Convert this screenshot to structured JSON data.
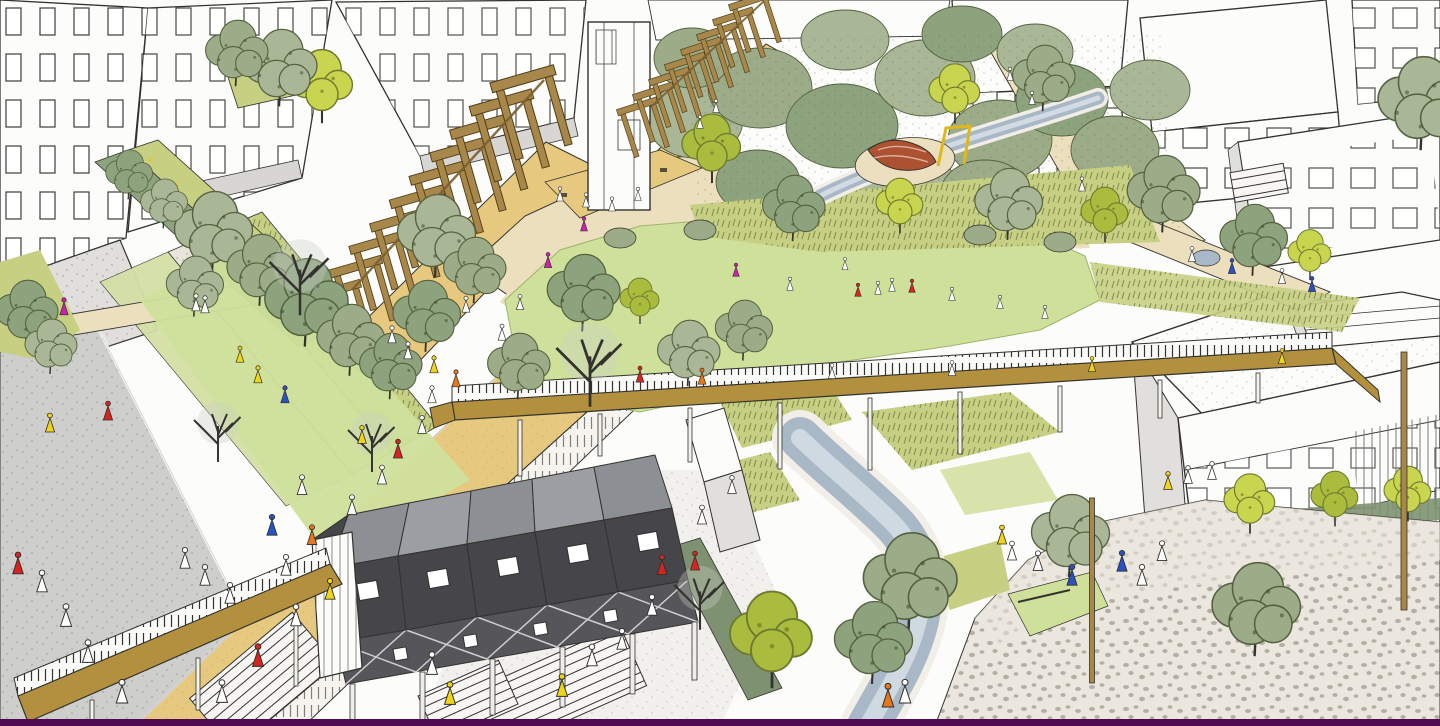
{
  "meta": {
    "scene_label": "Hand-drawn aerial masterplan sketch of an urban park with buildings, lawn, pergola, stream and plaza"
  },
  "palette": {
    "paper": "#fcfcfa",
    "ink": "#33322e",
    "buildingShade": "#e0dfdb",
    "roofGray": "#d7d6d2",
    "lawn": "#cfe09b",
    "grassWild": "#c6cf82",
    "treeSage": "#a9b796",
    "treeSageDark": "#8ca37e",
    "treeOlive": "#9cab88",
    "treeBright": "#c9d44f",
    "treeBrightDark": "#aabc3e",
    "pathBeige": "#ecdfbe",
    "sand": "#e6c87f",
    "deckOchre": "#b2903e",
    "wood": "#a8874a",
    "woodDark": "#6b5422",
    "water": "#a9b8c6",
    "waterLight": "#d6dee5",
    "roadGray": "#cecfcc",
    "plaza": "#ece7de",
    "darkWall": "#45454a",
    "darkRoof": "#8c8f93",
    "hedge": "#7e9271",
    "accentRed": "#d62420",
    "accentOrange": "#e5781c",
    "accentYellow": "#efd41c",
    "accentBlue": "#2a52c4",
    "accentMagenta": "#cf1fae",
    "purpleStrip": "#4d0a50",
    "playRed": "#ad5230",
    "playYellow": "#ddb818"
  },
  "people_colors": {
    "r": "accentRed",
    "o": "accentOrange",
    "y": "accentYellow",
    "b": "accentBlue",
    "m": "accentMagenta",
    "w": "#ffffff"
  },
  "scene": {
    "trees": [
      {
        "v": "sage",
        "x": 215,
        "y": 235,
        "s": 1.5
      },
      {
        "v": "sage",
        "x": 262,
        "y": 272,
        "s": 1.3
      },
      {
        "v": "sage",
        "x": 308,
        "y": 305,
        "s": 1.6
      },
      {
        "v": "sage",
        "x": 196,
        "y": 288,
        "s": 1.1
      },
      {
        "v": "sage",
        "x": 352,
        "y": 342,
        "s": 1.3
      },
      {
        "v": "sage",
        "x": 392,
        "y": 368,
        "s": 1.2
      },
      {
        "v": "bare",
        "x": 300,
        "y": 262,
        "s": 1.9
      },
      {
        "v": "bare",
        "x": 218,
        "y": 420,
        "s": 1.5
      },
      {
        "v": "sage",
        "x": 438,
        "y": 238,
        "s": 1.5
      },
      {
        "v": "sage",
        "x": 476,
        "y": 272,
        "s": 1.2
      },
      {
        "v": "sage",
        "x": 428,
        "y": 318,
        "s": 1.3
      },
      {
        "v": "bright",
        "x": 322,
        "y": 88,
        "s": 1.6
      },
      {
        "v": "sage",
        "x": 282,
        "y": 70,
        "s": 1.4
      },
      {
        "v": "sage",
        "x": 238,
        "y": 55,
        "s": 1.2
      },
      {
        "v": "bare",
        "x": 372,
        "y": 430,
        "s": 1.5
      },
      {
        "v": "sage",
        "x": 585,
        "y": 295,
        "s": 1.4
      },
      {
        "v": "bare",
        "x": 590,
        "y": 348,
        "s": 2.1
      },
      {
        "v": "sage",
        "x": 690,
        "y": 355,
        "s": 1.2
      },
      {
        "v": "sage",
        "x": 745,
        "y": 332,
        "s": 1.1
      },
      {
        "v": "bright",
        "x": 712,
        "y": 150,
        "s": 1.5
      },
      {
        "v": "sage",
        "x": 795,
        "y": 210,
        "s": 1.2
      },
      {
        "v": "bright",
        "x": 900,
        "y": 207,
        "s": 1.2
      },
      {
        "v": "sage",
        "x": 1010,
        "y": 206,
        "s": 1.3
      },
      {
        "v": "bright",
        "x": 1105,
        "y": 216,
        "s": 1.2
      },
      {
        "v": "sage",
        "x": 1165,
        "y": 196,
        "s": 1.4
      },
      {
        "v": "sage",
        "x": 1255,
        "y": 242,
        "s": 1.3
      },
      {
        "v": "bright",
        "x": 1310,
        "y": 256,
        "s": 1.1
      },
      {
        "v": "sage",
        "x": 1424,
        "y": 106,
        "s": 1.7
      },
      {
        "v": "sage",
        "x": 912,
        "y": 585,
        "s": 1.8
      },
      {
        "v": "sage",
        "x": 875,
        "y": 645,
        "s": 1.5
      },
      {
        "v": "bright",
        "x": 772,
        "y": 642,
        "s": 2.1
      },
      {
        "v": "sage",
        "x": 1072,
        "y": 538,
        "s": 1.5
      },
      {
        "v": "sage",
        "x": 1258,
        "y": 612,
        "s": 1.7
      },
      {
        "v": "bright",
        "x": 1250,
        "y": 505,
        "s": 1.3
      },
      {
        "v": "bright",
        "x": 1335,
        "y": 500,
        "s": 1.2
      },
      {
        "v": "bright",
        "x": 1408,
        "y": 495,
        "s": 1.2
      },
      {
        "v": "bare",
        "x": 700,
        "y": 585,
        "s": 1.6
      },
      {
        "v": "sage",
        "x": 28,
        "y": 315,
        "s": 1.2
      },
      {
        "v": "sage",
        "x": 52,
        "y": 348,
        "s": 1.0
      },
      {
        "v": "sage",
        "x": 520,
        "y": 368,
        "s": 1.2
      },
      {
        "v": "bright",
        "x": 640,
        "y": 302,
        "s": 1.0
      },
      {
        "v": "sage",
        "x": 130,
        "y": 176,
        "s": 0.9
      },
      {
        "v": "sage",
        "x": 165,
        "y": 205,
        "s": 0.9
      },
      {
        "v": "bright",
        "x": 955,
        "y": 95,
        "s": 1.3
      },
      {
        "v": "sage",
        "x": 1045,
        "y": 80,
        "s": 1.2
      }
    ],
    "people": [
      {
        "x": 222,
        "y": 688,
        "c": "w",
        "s": 1.2
      },
      {
        "x": 258,
        "y": 652,
        "c": "r",
        "s": 1.2
      },
      {
        "x": 296,
        "y": 612,
        "c": "w",
        "s": 1.15
      },
      {
        "x": 330,
        "y": 586,
        "c": "y",
        "s": 1.1
      },
      {
        "x": 286,
        "y": 562,
        "c": "w",
        "s": 1.1
      },
      {
        "x": 312,
        "y": 532,
        "c": "o",
        "s": 1.05
      },
      {
        "x": 352,
        "y": 502,
        "c": "w",
        "s": 1.05
      },
      {
        "x": 382,
        "y": 472,
        "c": "w",
        "s": 1.0
      },
      {
        "x": 398,
        "y": 446,
        "c": "r",
        "s": 1.0
      },
      {
        "x": 422,
        "y": 422,
        "c": "w",
        "s": 0.95
      },
      {
        "x": 362,
        "y": 432,
        "c": "y",
        "s": 0.95
      },
      {
        "x": 432,
        "y": 392,
        "c": "w",
        "s": 0.9
      },
      {
        "x": 456,
        "y": 376,
        "c": "o",
        "s": 0.9
      },
      {
        "x": 302,
        "y": 482,
        "c": "w",
        "s": 1.05
      },
      {
        "x": 272,
        "y": 522,
        "c": "b",
        "s": 1.1
      },
      {
        "x": 258,
        "y": 372,
        "c": "y",
        "s": 0.9
      },
      {
        "x": 285,
        "y": 392,
        "c": "b",
        "s": 0.9
      },
      {
        "x": 240,
        "y": 352,
        "c": "y",
        "s": 0.85
      },
      {
        "x": 50,
        "y": 420,
        "c": "y",
        "s": 1.0
      },
      {
        "x": 108,
        "y": 408,
        "c": "r",
        "s": 1.0
      },
      {
        "x": 18,
        "y": 560,
        "c": "r",
        "s": 1.15
      },
      {
        "x": 42,
        "y": 578,
        "c": "w",
        "s": 1.15
      },
      {
        "x": 66,
        "y": 612,
        "c": "w",
        "s": 1.2
      },
      {
        "x": 88,
        "y": 648,
        "c": "w",
        "s": 1.2
      },
      {
        "x": 122,
        "y": 688,
        "c": "w",
        "s": 1.25
      },
      {
        "x": 185,
        "y": 555,
        "c": "w",
        "s": 1.1
      },
      {
        "x": 205,
        "y": 572,
        "c": "w",
        "s": 1.1
      },
      {
        "x": 230,
        "y": 590,
        "c": "w",
        "s": 1.1
      },
      {
        "x": 64,
        "y": 304,
        "c": "m",
        "s": 0.9
      },
      {
        "x": 196,
        "y": 300,
        "c": "w",
        "s": 0.9
      },
      {
        "x": 205,
        "y": 302,
        "c": "w",
        "s": 0.9
      },
      {
        "x": 560,
        "y": 192,
        "c": "w",
        "s": 0.75
      },
      {
        "x": 586,
        "y": 198,
        "c": "w",
        "s": 0.75
      },
      {
        "x": 612,
        "y": 202,
        "c": "w",
        "s": 0.75
      },
      {
        "x": 638,
        "y": 192,
        "c": "w",
        "s": 0.7
      },
      {
        "x": 584,
        "y": 222,
        "c": "m",
        "s": 0.75
      },
      {
        "x": 548,
        "y": 258,
        "c": "m",
        "s": 0.8
      },
      {
        "x": 520,
        "y": 300,
        "c": "w",
        "s": 0.8
      },
      {
        "x": 502,
        "y": 330,
        "c": "w",
        "s": 0.85
      },
      {
        "x": 392,
        "y": 332,
        "c": "w",
        "s": 0.9
      },
      {
        "x": 408,
        "y": 348,
        "c": "w",
        "s": 0.9
      },
      {
        "x": 434,
        "y": 362,
        "c": "y",
        "s": 0.9
      },
      {
        "x": 466,
        "y": 302,
        "c": "w",
        "s": 0.85
      },
      {
        "x": 700,
        "y": 120,
        "c": "w",
        "s": 0.7
      },
      {
        "x": 716,
        "y": 104,
        "c": "w",
        "s": 0.7
      },
      {
        "x": 736,
        "y": 268,
        "c": "m",
        "s": 0.7
      },
      {
        "x": 790,
        "y": 282,
        "c": "w",
        "s": 0.7
      },
      {
        "x": 858,
        "y": 288,
        "c": "r",
        "s": 0.7
      },
      {
        "x": 878,
        "y": 286,
        "c": "w",
        "s": 0.7
      },
      {
        "x": 892,
        "y": 283,
        "c": "w",
        "s": 0.7
      },
      {
        "x": 912,
        "y": 284,
        "c": "r",
        "s": 0.7
      },
      {
        "x": 952,
        "y": 292,
        "c": "w",
        "s": 0.7
      },
      {
        "x": 845,
        "y": 262,
        "c": "w",
        "s": 0.65
      },
      {
        "x": 1000,
        "y": 300,
        "c": "w",
        "s": 0.7
      },
      {
        "x": 1045,
        "y": 310,
        "c": "w",
        "s": 0.7
      },
      {
        "x": 640,
        "y": 372,
        "c": "r",
        "s": 0.85
      },
      {
        "x": 702,
        "y": 374,
        "c": "o",
        "s": 0.85
      },
      {
        "x": 832,
        "y": 369,
        "c": "w",
        "s": 0.8
      },
      {
        "x": 952,
        "y": 366,
        "c": "w",
        "s": 0.8
      },
      {
        "x": 1092,
        "y": 362,
        "c": "y",
        "s": 0.8
      },
      {
        "x": 1282,
        "y": 354,
        "c": "y",
        "s": 0.8
      },
      {
        "x": 1010,
        "y": 72,
        "c": "w",
        "s": 0.7
      },
      {
        "x": 1032,
        "y": 96,
        "c": "w",
        "s": 0.7
      },
      {
        "x": 1082,
        "y": 182,
        "c": "w",
        "s": 0.75
      },
      {
        "x": 1192,
        "y": 252,
        "c": "w",
        "s": 0.8
      },
      {
        "x": 1232,
        "y": 264,
        "c": "b",
        "s": 0.8
      },
      {
        "x": 1282,
        "y": 274,
        "c": "w",
        "s": 0.8
      },
      {
        "x": 1312,
        "y": 282,
        "c": "b",
        "s": 0.8
      },
      {
        "x": 562,
        "y": 682,
        "c": "y",
        "s": 1.2
      },
      {
        "x": 592,
        "y": 652,
        "c": "w",
        "s": 1.15
      },
      {
        "x": 622,
        "y": 636,
        "c": "w",
        "s": 1.1
      },
      {
        "x": 652,
        "y": 602,
        "c": "w",
        "s": 1.1
      },
      {
        "x": 662,
        "y": 562,
        "c": "r",
        "s": 1.05
      },
      {
        "x": 702,
        "y": 512,
        "c": "w",
        "s": 1.0
      },
      {
        "x": 732,
        "y": 482,
        "c": "w",
        "s": 0.95
      },
      {
        "x": 695,
        "y": 558,
        "c": "r",
        "s": 1.0
      },
      {
        "x": 1002,
        "y": 532,
        "c": "y",
        "s": 1.0
      },
      {
        "x": 1012,
        "y": 548,
        "c": "w",
        "s": 1.0
      },
      {
        "x": 1038,
        "y": 558,
        "c": "w",
        "s": 1.05
      },
      {
        "x": 1072,
        "y": 572,
        "c": "b",
        "s": 1.1
      },
      {
        "x": 1122,
        "y": 558,
        "c": "b",
        "s": 1.1
      },
      {
        "x": 1142,
        "y": 572,
        "c": "w",
        "s": 1.1
      },
      {
        "x": 1162,
        "y": 548,
        "c": "w",
        "s": 1.05
      },
      {
        "x": 1168,
        "y": 478,
        "c": "y",
        "s": 0.95
      },
      {
        "x": 1188,
        "y": 472,
        "c": "w",
        "s": 0.95
      },
      {
        "x": 1212,
        "y": 468,
        "c": "w",
        "s": 0.95
      },
      {
        "x": 888,
        "y": 692,
        "c": "o",
        "s": 1.25
      },
      {
        "x": 905,
        "y": 688,
        "c": "w",
        "s": 1.25
      },
      {
        "x": 450,
        "y": 690,
        "c": "y",
        "s": 1.2
      },
      {
        "x": 432,
        "y": 660,
        "c": "w",
        "s": 1.2
      }
    ],
    "pergola_main": [
      {
        "x": 352,
        "y": 348,
        "s": 1.0,
        "r": -16
      },
      {
        "x": 373,
        "y": 326,
        "s": 1.03,
        "r": -16
      },
      {
        "x": 394,
        "y": 304,
        "s": 1.06,
        "r": -16
      },
      {
        "x": 416,
        "y": 283,
        "s": 1.09,
        "r": -16
      },
      {
        "x": 437,
        "y": 261,
        "s": 1.12,
        "r": -16
      },
      {
        "x": 458,
        "y": 239,
        "s": 1.15,
        "r": -16
      },
      {
        "x": 480,
        "y": 217,
        "s": 1.18,
        "r": -16
      },
      {
        "x": 501,
        "y": 196,
        "s": 1.21,
        "r": -16
      },
      {
        "x": 522,
        "y": 174,
        "s": 1.24,
        "r": -16
      },
      {
        "x": 544,
        "y": 152,
        "s": 1.27,
        "r": -16
      }
    ],
    "pergola_upper": [
      {
        "x": 652,
        "y": 152,
        "s": 0.8,
        "r": -18
      },
      {
        "x": 668,
        "y": 137,
        "s": 0.8,
        "r": -18
      },
      {
        "x": 684,
        "y": 122,
        "s": 0.8,
        "r": -18
      },
      {
        "x": 700,
        "y": 107,
        "s": 0.8,
        "r": -18
      },
      {
        "x": 716,
        "y": 92,
        "s": 0.8,
        "r": -18
      },
      {
        "x": 732,
        "y": 77,
        "s": 0.8,
        "r": -18
      },
      {
        "x": 748,
        "y": 62,
        "s": 0.8,
        "r": -18
      },
      {
        "x": 764,
        "y": 47,
        "s": 0.8,
        "r": -18
      }
    ],
    "walkway_posts": [
      {
        "x": 520,
        "y": 420,
        "h": 56
      },
      {
        "x": 600,
        "y": 414,
        "h": 42
      },
      {
        "x": 690,
        "y": 408,
        "h": 54
      },
      {
        "x": 780,
        "y": 403,
        "h": 66
      },
      {
        "x": 870,
        "y": 398,
        "h": 72
      },
      {
        "x": 960,
        "y": 392,
        "h": 62
      },
      {
        "x": 1060,
        "y": 386,
        "h": 46
      },
      {
        "x": 1160,
        "y": 380,
        "h": 38
      },
      {
        "x": 1258,
        "y": 373,
        "h": 30
      }
    ],
    "bridge_posts": [
      {
        "x": 92,
        "y": 700,
        "h": 26
      },
      {
        "x": 198,
        "y": 658,
        "h": 52
      },
      {
        "x": 296,
        "y": 616,
        "h": 70
      }
    ],
    "poles": [
      {
        "x": 1092,
        "y": 498,
        "h": 185,
        "w": 5
      },
      {
        "x": 1404,
        "y": 352,
        "h": 258,
        "w": 6
      }
    ]
  }
}
